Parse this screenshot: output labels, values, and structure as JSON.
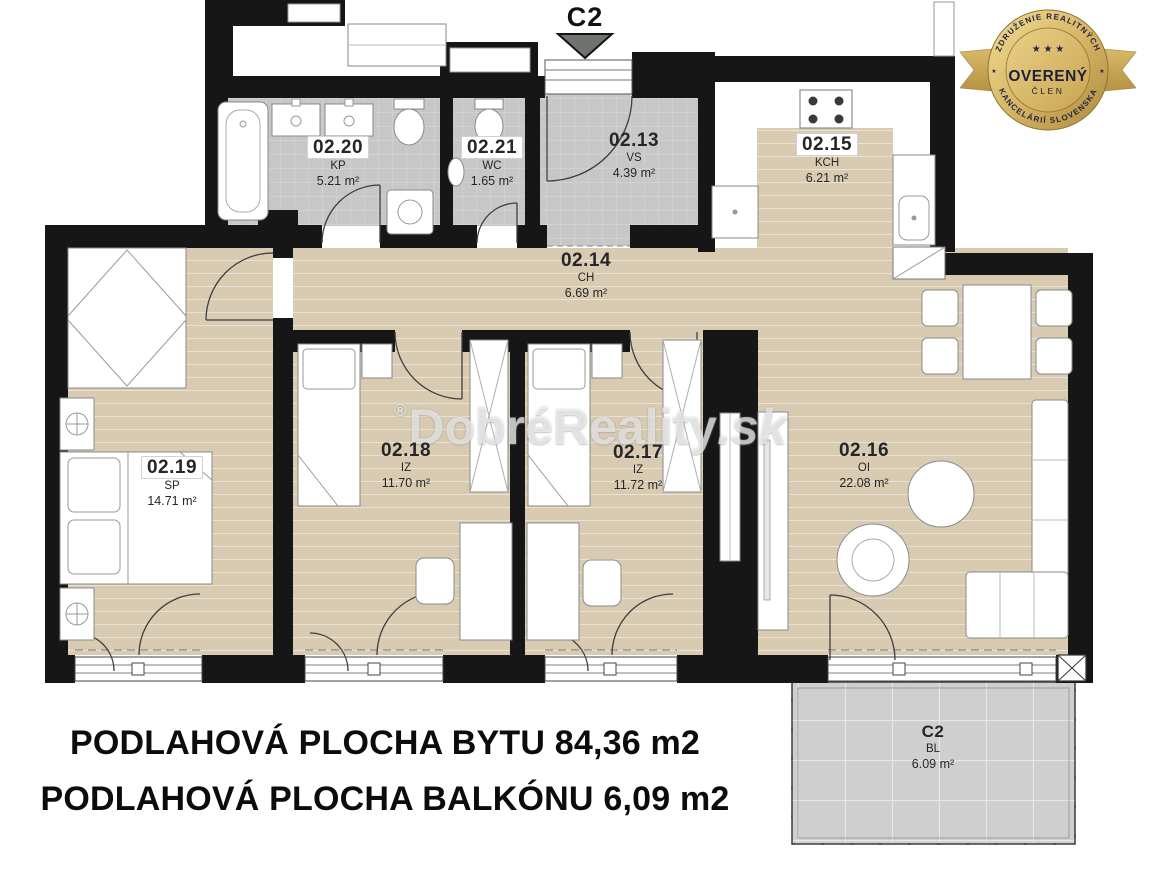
{
  "plan": {
    "entrance_label": "C2",
    "summary_line1": "PODLAHOVÁ PLOCHA BYTU 84,36 m2",
    "summary_line2": "PODLAHOVÁ PLOCHA BALKÓNU 6,09 m2",
    "watermark_reg": "®",
    "watermark_text": "DobréReality",
    "watermark_suffix": ".sk",
    "colors": {
      "wall_black": "#161616",
      "floor_beige": "#d8cbb2",
      "tile_gray": "#c7c7c7",
      "balcony_gray": "#cfcfcf",
      "badge_gold": "#d7b665"
    }
  },
  "rooms": [
    {
      "code": "02.20",
      "abbr": "KP",
      "area": "5.21 m²"
    },
    {
      "code": "02.21",
      "abbr": "WC",
      "area": "1.65 m²"
    },
    {
      "code": "02.13",
      "abbr": "VS",
      "area": "4.39 m²"
    },
    {
      "code": "02.15",
      "abbr": "KCH",
      "area": "6.21 m²"
    },
    {
      "code": "02.14",
      "abbr": "CH",
      "area": "6.69 m²"
    },
    {
      "code": "02.19",
      "abbr": "SP",
      "area": "14.71 m²"
    },
    {
      "code": "02.18",
      "abbr": "IZ",
      "area": "11.70 m²"
    },
    {
      "code": "02.17",
      "abbr": "IZ",
      "area": "11.72 m²"
    },
    {
      "code": "02.16",
      "abbr": "OI",
      "area": "22.08 m²"
    }
  ],
  "balcony": {
    "code": "C2",
    "abbr": "BL",
    "area": "6.09 m²"
  },
  "badge": {
    "arc_top": "ZDRUŽENIE REALITNÝCH",
    "arc_bottom": "KANCELÁRIÍ SLOVENSKA",
    "stars": "★ ★ ★",
    "side_star": "★",
    "title": "OVERENÝ",
    "subtitle": "ČLEN"
  }
}
